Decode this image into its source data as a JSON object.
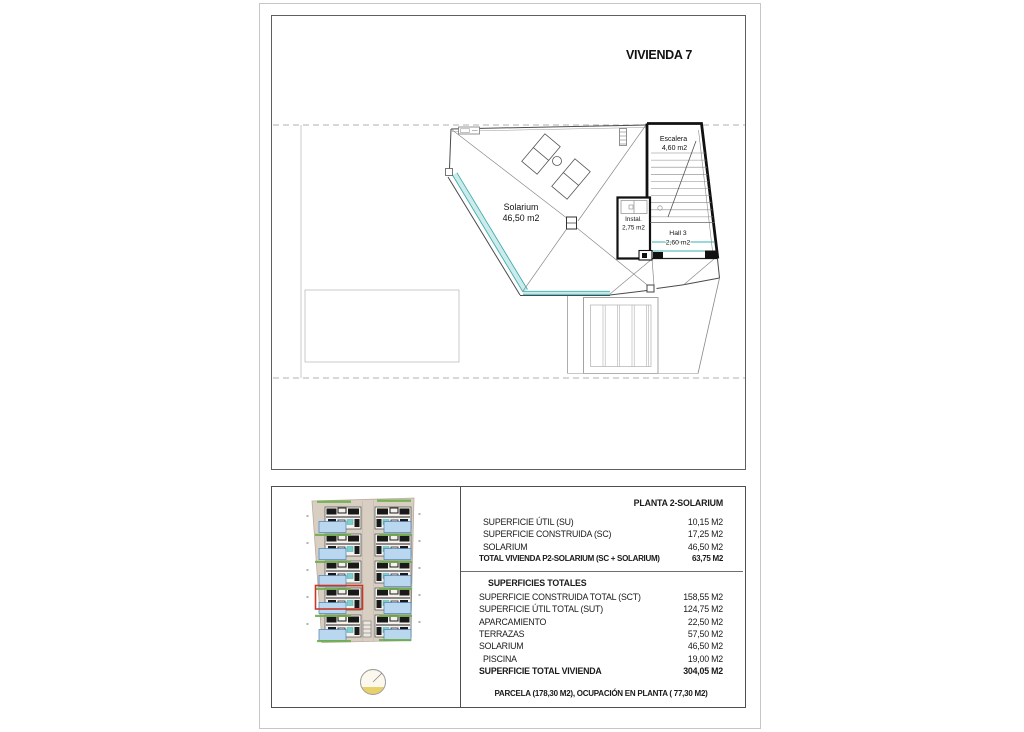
{
  "page": {
    "title": "VIVIENDA 7"
  },
  "floor_plan": {
    "rooms": [
      {
        "name": "Solarium",
        "area": "46,50 m2"
      },
      {
        "name": "Escalera",
        "area": "4,60 m2"
      },
      {
        "name": "Instal.",
        "area": "2,75 m2"
      },
      {
        "name": "Hall 3",
        "area": "2,60 m2"
      }
    ]
  },
  "summary": {
    "section1": {
      "header": "PLANTA 2-SOLARIUM",
      "rows": [
        {
          "label": "SUPERFICIE ÚTIL (SU)",
          "value": "10,15 M2"
        },
        {
          "label": "SUPERFICIE CONSTRUIDA (SC)",
          "value": "17,25 M2"
        },
        {
          "label": "SOLARIUM",
          "value": "46,50 M2"
        }
      ],
      "total": {
        "label": "TOTAL VIVIENDA P2-SOLARIUM (SC + SOLARIUM)",
        "value": "63,75 M2"
      }
    },
    "section2": {
      "header": "SUPERFICIES TOTALES",
      "rows": [
        {
          "label": "SUPERFICIE CONSTRUIDA TOTAL (SCT)",
          "value": "158,55 M2"
        },
        {
          "label": "SUPERFICIE ÚTIL TOTAL (SUT)",
          "value": "124,75 M2"
        },
        {
          "label": "APARCAMIENTO",
          "value": "22,50 M2"
        },
        {
          "label": "TERRAZAS",
          "value": "57,50 M2"
        },
        {
          "label": "SOLARIUM",
          "value": "46,50 M2"
        },
        {
          "label": "PISCINA",
          "value": "19,00 M2"
        }
      ],
      "total": {
        "label": "SUPERFICIE TOTAL VIVIENDA",
        "value": "304,05 M2"
      }
    },
    "footer": "PARCELA  (178,30 M2), OCUPACIÓN EN PLANTA ( 77,30 M2)"
  },
  "colors": {
    "glass_cyan": "#3ab0b0",
    "glass_cyan_fill": "#cfeaea",
    "highlight_red": "#c8372a",
    "pool_blue": "#b9d7ee",
    "green_strip": "#6fae4e",
    "plot_beige": "#d8cec2",
    "north_yellow": "#e8d06a"
  }
}
